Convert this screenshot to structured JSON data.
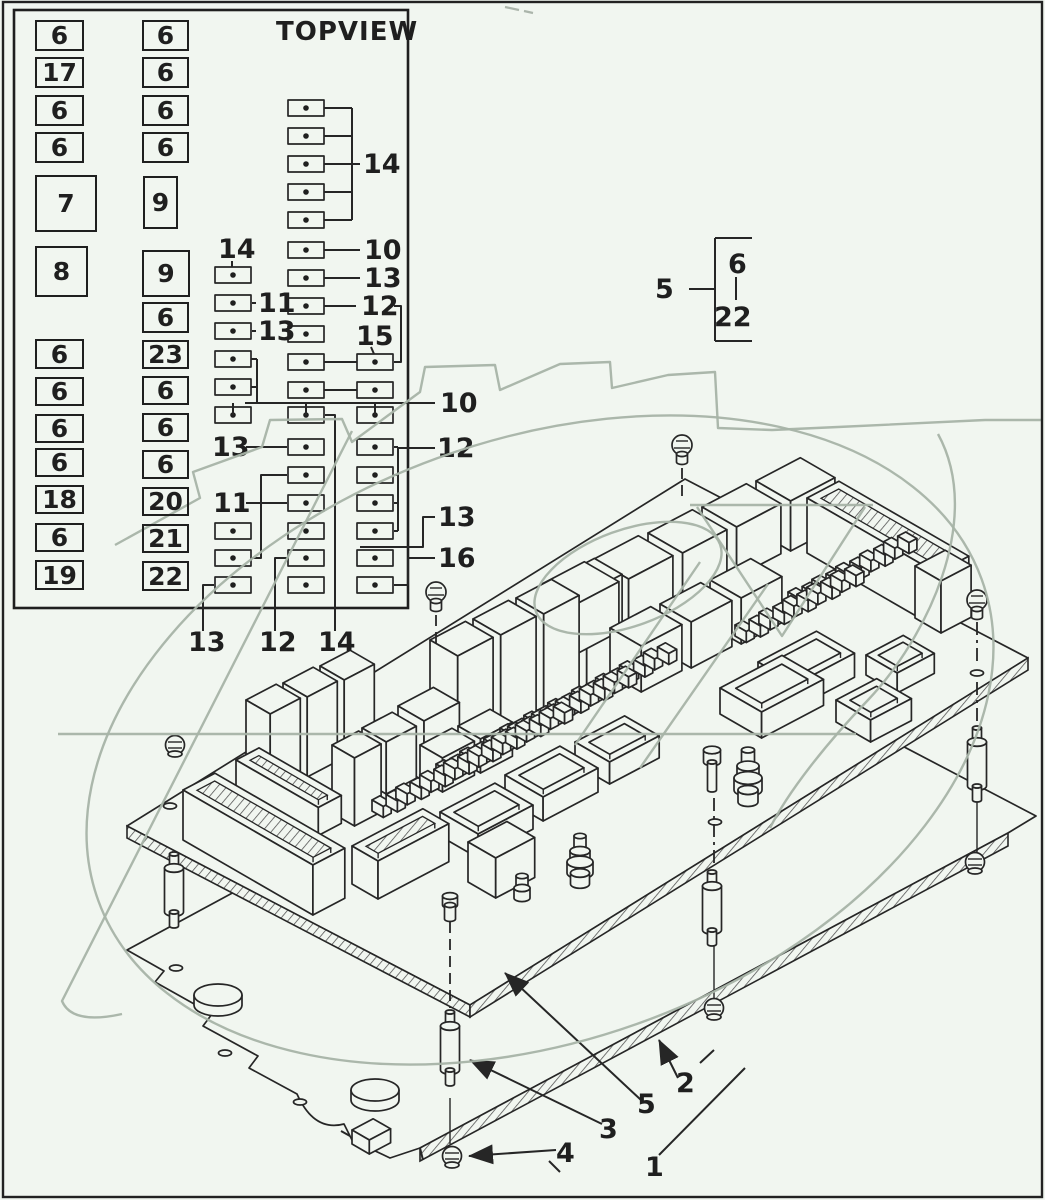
{
  "topview": {
    "title": "TOPVIEW",
    "left_column": [
      "6",
      "17",
      "6",
      "6",
      "7",
      "8",
      "6",
      "6",
      "6",
      "6",
      "18",
      "6",
      "19"
    ],
    "right_column": [
      "6",
      "6",
      "6",
      "6",
      "9",
      "9",
      "6",
      "23",
      "6",
      "6",
      "6",
      "20",
      "21",
      "22"
    ],
    "callouts": {
      "bracket_14": "14",
      "row_10": "10",
      "row_13": "13",
      "row_12": "12",
      "c15": "15",
      "a_top_14": "14",
      "a_11": "11",
      "a_13": "13",
      "right_10": "10",
      "right_12": "12",
      "right_13": "13",
      "right_16": "16",
      "left_13": "13",
      "left_11": "11",
      "bottom_13": "13",
      "bottom_12": "12",
      "bottom_14": "14"
    }
  },
  "legend": {
    "item": "5",
    "first": "6",
    "last": "22"
  },
  "assembly": {
    "callout_1": "1",
    "callout_2": "2",
    "callout_3": "3",
    "callout_4": "4",
    "callout_5": "5"
  }
}
